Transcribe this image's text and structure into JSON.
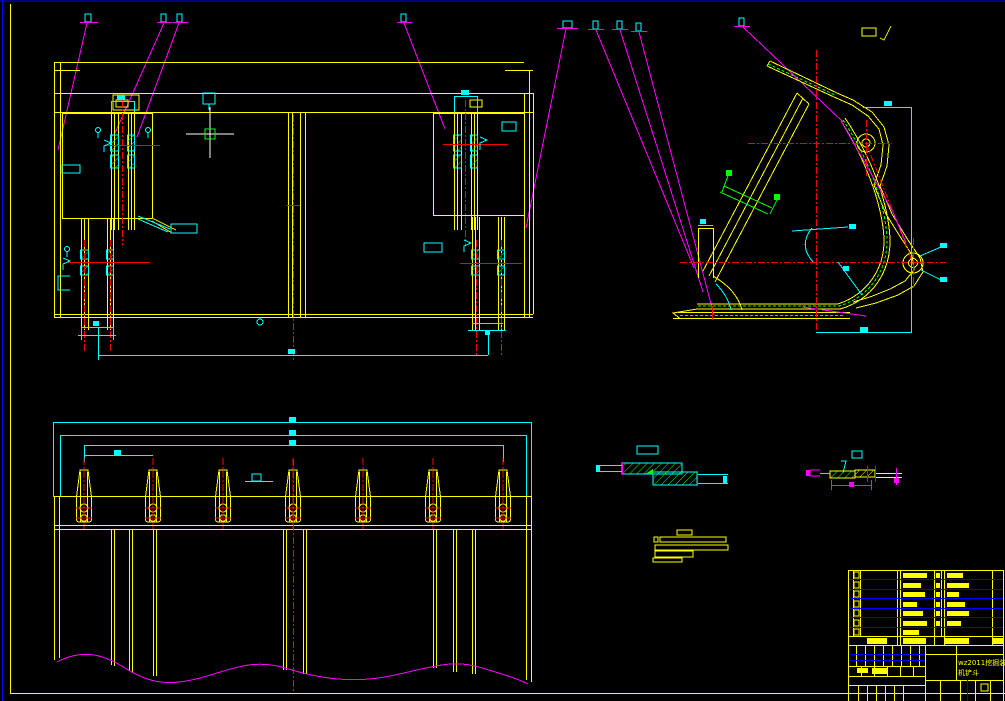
{
  "drawing": {
    "background": "#000000",
    "colors": {
      "outline": "#ffff00",
      "dimension": "#00ffff",
      "centerline": "#ff0000",
      "leader": "#ff00ff",
      "hatch": "#00ff00",
      "sheet_frame": "#0000ff",
      "cursor": "#ffffff",
      "pickbox": "#00ff00"
    },
    "title_block": {
      "title_line1": "wz2011挖掘装载",
      "title_line2": "机铲斗"
    },
    "views": {
      "front_view": {
        "name": "bucket-front-view",
        "balloon_count": 4
      },
      "side_view": {
        "name": "bucket-side-view",
        "balloon_count": 5,
        "hinge_holes": 2
      },
      "bottom_view": {
        "name": "bucket-bottom-view",
        "teeth_count": 7,
        "bolts_per_tooth": 2
      },
      "sections": {
        "name": "section-details",
        "count": 3
      }
    },
    "bom": {
      "row_count": 7
    },
    "cursor": {
      "x": 210,
      "y": 134
    }
  }
}
